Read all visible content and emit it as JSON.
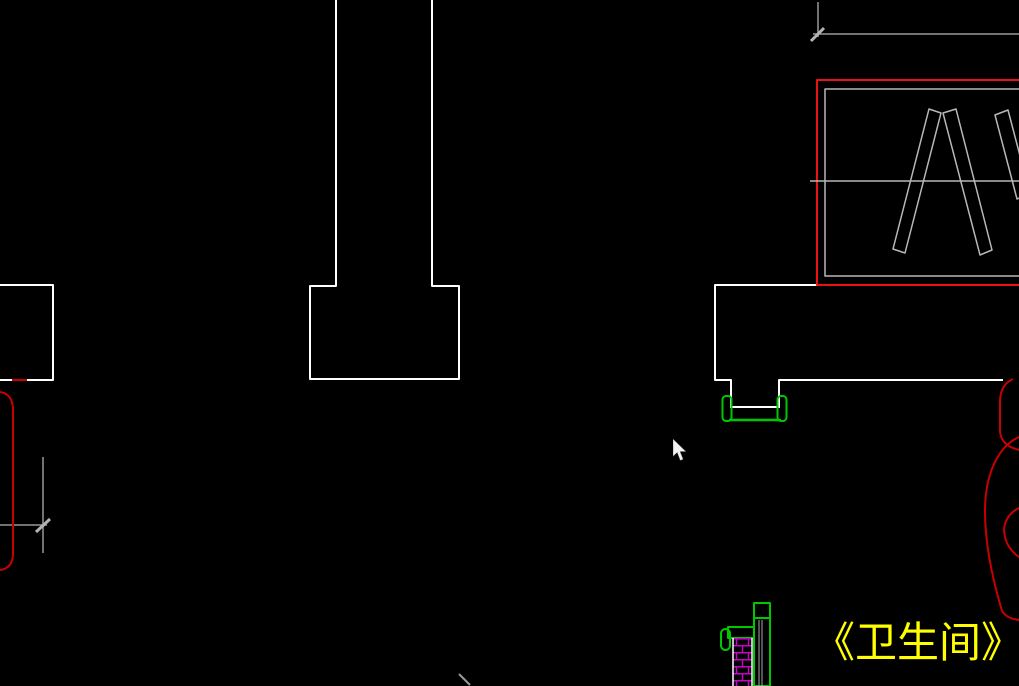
{
  "meta": {
    "app": "cad-drawing-viewport",
    "canvas_width": 1019,
    "canvas_height": 686,
    "background": "#000000"
  },
  "colors": {
    "wall": "#FFFFFF",
    "panel": "#B8B8B8",
    "dim": "#989898",
    "tick": "#B4B4B4",
    "red": "#EE1111",
    "darkred": "#C80000",
    "green": "#00C800",
    "magenta": "#CC00CC",
    "pipe": "#A8A8A8",
    "label_yellow": "#FFFF00",
    "cursor_fill": "#F2F2F2"
  },
  "annotation": {
    "title_label": "《卫生间》",
    "x": 813,
    "y": 620
  },
  "cursor": {
    "x": 673,
    "y": 439
  },
  "drawing": {
    "elements": [
      {
        "name": "column-shaft-and-footing",
        "type": "polyline",
        "color": "wall",
        "width": 2,
        "points": [
          [
            336,
            0
          ],
          [
            336,
            286
          ],
          [
            310,
            286
          ],
          [
            310,
            379
          ],
          [
            459,
            379
          ],
          [
            459,
            286
          ],
          [
            432,
            286
          ],
          [
            432,
            0
          ]
        ]
      },
      {
        "name": "left-wall-corner",
        "type": "polyline",
        "color": "wall",
        "width": 2,
        "points": [
          [
            0,
            285
          ],
          [
            53,
            285
          ],
          [
            53,
            380
          ],
          [
            0,
            380
          ]
        ]
      },
      {
        "name": "right-wall-outline",
        "type": "polyline",
        "color": "wall",
        "width": 2,
        "points": [
          [
            817,
            285
          ],
          [
            715,
            285
          ],
          [
            715,
            380
          ],
          [
            731,
            380
          ],
          [
            731,
            408
          ]
        ]
      },
      {
        "name": "window-right-jamb-and-wall",
        "type": "polyline",
        "color": "wall",
        "width": 2,
        "points": [
          [
            779,
            408
          ],
          [
            779,
            380
          ],
          [
            1003,
            380
          ]
        ]
      },
      {
        "name": "window-sill-line",
        "type": "line",
        "color": "wall",
        "width": 2,
        "x1": 731,
        "y1": 407,
        "x2": 780,
        "y2": 407
      },
      {
        "name": "red-room-outline",
        "type": "path",
        "color": "red",
        "width": 2,
        "d": "M 1019,80 L 817,80 L 817,285 L 1019,285"
      },
      {
        "name": "inner-panel-rect",
        "type": "path",
        "color": "panel",
        "width": 1.5,
        "d": "M 1019,89 L 825,89 L 825,276 L 1019,276"
      },
      {
        "name": "panel-divider-line",
        "type": "line",
        "color": "panel",
        "width": 1.5,
        "x1": 810,
        "y1": 181,
        "x2": 1019,
        "y2": 181
      },
      {
        "name": "hatch-bar-1",
        "type": "polygon",
        "color": "panel",
        "width": 1.5,
        "points": [
          [
            893,
            249
          ],
          [
            905,
            253
          ],
          [
            941,
            113
          ],
          [
            929,
            109
          ]
        ]
      },
      {
        "name": "hatch-bar-2",
        "type": "polygon",
        "color": "panel",
        "width": 1.5,
        "points": [
          [
            943,
            113
          ],
          [
            956,
            109
          ],
          [
            992,
            250
          ],
          [
            980,
            255
          ]
        ]
      },
      {
        "name": "hatch-bar-3",
        "type": "polygon",
        "color": "panel",
        "width": 1.5,
        "points": [
          [
            995,
            115
          ],
          [
            1008,
            110
          ],
          [
            1030,
            194
          ],
          [
            1017,
            199
          ]
        ]
      },
      {
        "name": "dim-extension-line-top",
        "type": "line",
        "color": "dim",
        "width": 1.5,
        "x1": 818,
        "y1": 2,
        "x2": 818,
        "y2": 37
      },
      {
        "name": "dim-line-top",
        "type": "line",
        "color": "dim",
        "width": 1.5,
        "x1": 813,
        "y1": 34,
        "x2": 1019,
        "y2": 34
      },
      {
        "name": "dim-tick-top",
        "type": "line",
        "color": "tick",
        "width": 3,
        "x1": 811,
        "y1": 41,
        "x2": 824,
        "y2": 28
      },
      {
        "name": "dim-extension-line-left",
        "type": "line",
        "color": "dim",
        "width": 1.5,
        "x1": 43,
        "y1": 457,
        "x2": 43,
        "y2": 553
      },
      {
        "name": "dim-line-left",
        "type": "line",
        "color": "dim",
        "width": 1.5,
        "x1": 0,
        "y1": 525,
        "x2": 47,
        "y2": 525
      },
      {
        "name": "dim-tick-left",
        "type": "line",
        "color": "tick",
        "width": 3,
        "x1": 36,
        "y1": 532,
        "x2": 50,
        "y2": 519
      },
      {
        "name": "dim-tick-bottom",
        "type": "line",
        "color": "dim",
        "width": 2,
        "x1": 459,
        "y1": 674,
        "x2": 470,
        "y2": 685
      },
      {
        "name": "left-curved-bracket",
        "type": "path",
        "color": "darkred",
        "width": 2,
        "d": "M 0,392 C 8,393 13,399 13,410 L 13,553 C 13,564 8,569 0,570"
      },
      {
        "name": "left-bracket-tip",
        "type": "line",
        "color": "darkred",
        "width": 2,
        "x1": 12,
        "y1": 380,
        "x2": 27,
        "y2": 380
      },
      {
        "name": "right-arc-upper",
        "type": "path",
        "color": "darkred",
        "width": 2,
        "d": "M 1013,379 C 1004,383 1000,391 1000,402 L 1000,430 C 1000,441 1007,447 1019,450"
      },
      {
        "name": "right-arc-outer",
        "type": "path",
        "color": "darkred",
        "width": 2,
        "d": "M 1019,437 C 997,447 985,476 985,511 C 985,546 993,581 1002,611 C 1005,616 1011,619 1019,620"
      },
      {
        "name": "right-arc-inner",
        "type": "path",
        "color": "darkred",
        "width": 2,
        "d": "M 1019,508 C 1007,514 1002,525 1005,537 C 1007,546 1013,553 1019,557"
      },
      {
        "name": "window-stop-left",
        "type": "rect",
        "color": "green",
        "width": 2,
        "x": 722.5,
        "y": 396,
        "w": 9,
        "h": 25,
        "rx": 3.5
      },
      {
        "name": "window-stop-right",
        "type": "rect",
        "color": "green",
        "width": 2,
        "x": 777.5,
        "y": 396,
        "w": 9,
        "h": 25,
        "rx": 3.5
      },
      {
        "name": "window-track-line",
        "type": "line",
        "color": "green",
        "width": 2.5,
        "x1": 729,
        "y1": 420,
        "x2": 781,
        "y2": 420
      },
      {
        "name": "pipe-chase-outline",
        "type": "rect",
        "color": "green",
        "width": 2,
        "x": 754,
        "y": 603,
        "w": 16,
        "h": 83,
        "rx": 0
      },
      {
        "name": "pipe-chase-divider",
        "type": "line",
        "color": "green",
        "width": 2,
        "x1": 754,
        "y1": 618,
        "x2": 770,
        "y2": 618
      },
      {
        "name": "pipe-line-1",
        "type": "line",
        "color": "pipe",
        "width": 1,
        "x1": 759,
        "y1": 620,
        "x2": 759,
        "y2": 686
      },
      {
        "name": "pipe-line-2",
        "type": "line",
        "color": "pipe",
        "width": 1,
        "x1": 762,
        "y1": 620,
        "x2": 762,
        "y2": 686
      },
      {
        "name": "fixture-top-bar",
        "type": "rect",
        "color": "green",
        "width": 2,
        "x": 728,
        "y": 627,
        "w": 26,
        "h": 11,
        "rx": 0
      },
      {
        "name": "fixture-hook",
        "type": "rect",
        "color": "green",
        "width": 2,
        "x": 721,
        "y": 629,
        "w": 9,
        "h": 21,
        "rx": 4.5
      },
      {
        "name": "brick-column-hatch",
        "type": "rect",
        "color": "none",
        "fill": "brick",
        "width": 0,
        "x": 733,
        "y": 638,
        "w": 19,
        "h": 48,
        "rx": 0
      },
      {
        "name": "brick-column-left-edge",
        "type": "line",
        "color": "wall",
        "width": 1.5,
        "x1": 733,
        "y1": 638,
        "x2": 733,
        "y2": 686
      },
      {
        "name": "brick-column-right-edge",
        "type": "line",
        "color": "wall",
        "width": 1.5,
        "x1": 752,
        "y1": 638,
        "x2": 752,
        "y2": 686
      }
    ]
  }
}
